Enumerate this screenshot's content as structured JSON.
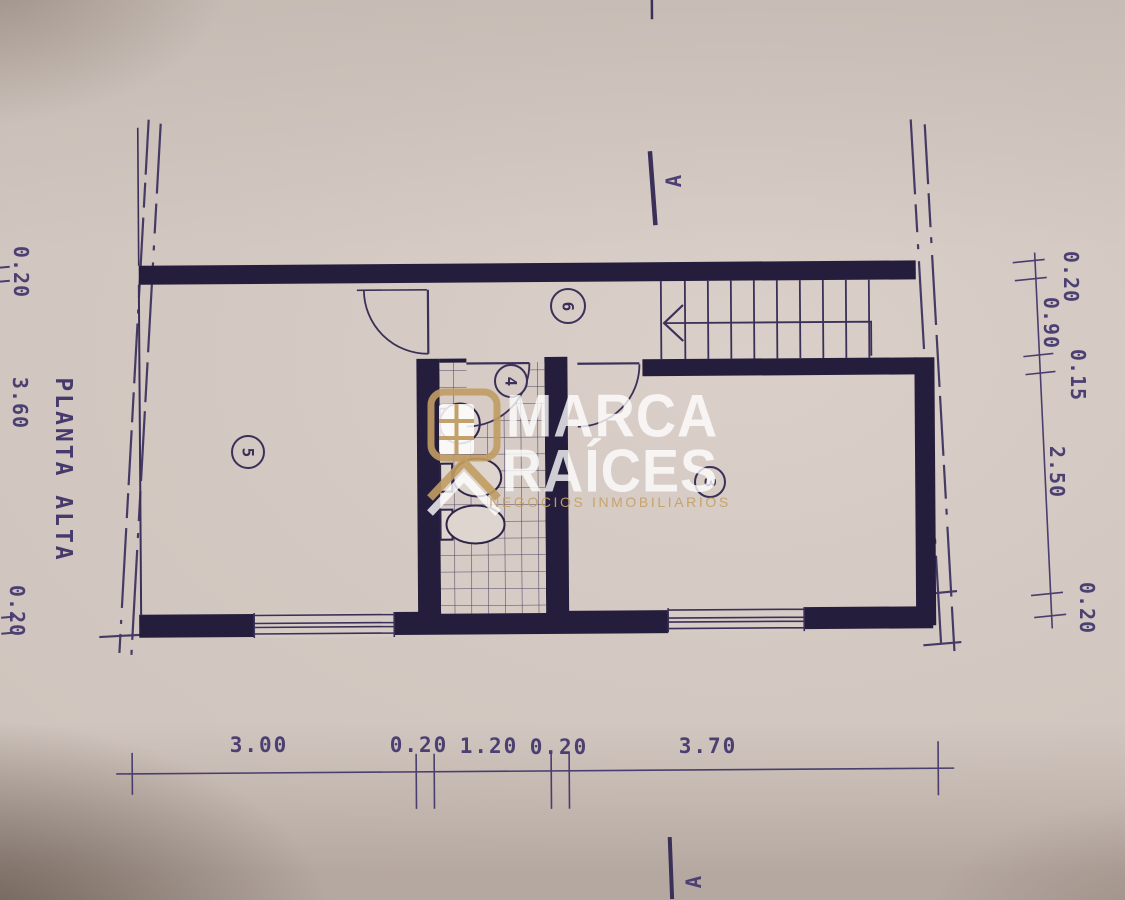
{
  "plan": {
    "floor_title": "PLANTA ALTA",
    "room_labels": {
      "room5": "5",
      "room6": "6",
      "room4": "4",
      "room3": "3"
    },
    "section_markers": {
      "top": "A",
      "bottom": "A"
    },
    "dimensions": {
      "bottom": [
        "3.00",
        "0.20",
        "1.20",
        "0.20",
        "3.70"
      ],
      "left": [
        "0.20",
        "3.60",
        "0.20"
      ],
      "right": [
        "0.20",
        "0.90",
        "0.15",
        "2.50",
        "0.20"
      ]
    }
  },
  "watermark": {
    "brand_top": "MARCA",
    "brand_bottom": "RAÍCES",
    "tagline": "NEGOCIOS INMOBILIARIOS"
  },
  "colors": {
    "ink": "#3a3058",
    "wall": "#251d3c",
    "paper": "#d4c9c2",
    "gold": "#bd9b62"
  }
}
